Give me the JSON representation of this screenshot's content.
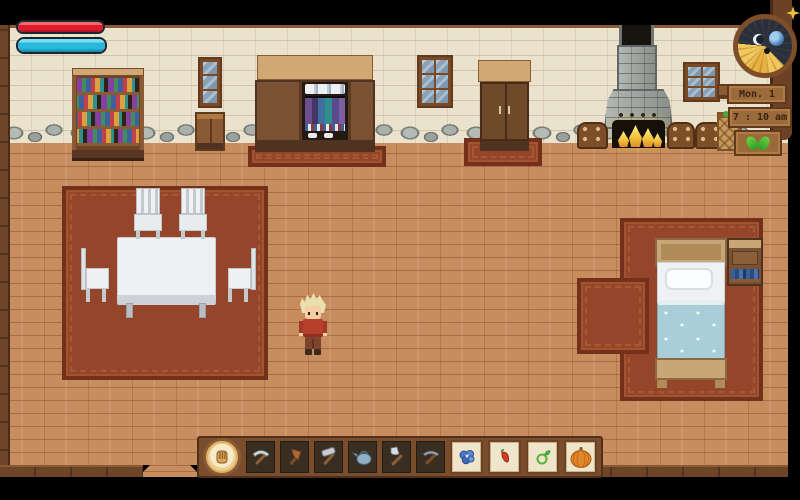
{
  "hud": {
    "health_bar": {
      "label": "health",
      "fill_percent": 100,
      "color": "#e01c2c"
    },
    "mana_bar": {
      "label": "mana",
      "fill_percent": 100,
      "color": "#29b7dc"
    }
  },
  "clock": {
    "day_label": "Mon. 1",
    "time_label": "7 : 10 am",
    "season": "spring",
    "season_icon": "sprout-icon",
    "dial_icons": [
      "sun-rays-dial",
      "moon-icon",
      "small-moon-icon",
      "star-icon"
    ]
  },
  "hotbar": {
    "selected_index": 0,
    "slots": [
      {
        "icon": "glove-icon",
        "item": "empty hand"
      },
      {
        "icon": "pickaxe-icon",
        "item": "pickaxe"
      },
      {
        "icon": "axe-icon",
        "item": "axe"
      },
      {
        "icon": "hammer-icon",
        "item": "hammer"
      },
      {
        "icon": "watering-can-icon",
        "item": "watering can"
      },
      {
        "icon": "shovel-icon",
        "item": "shovel"
      },
      {
        "icon": "dark-pickaxe-icon",
        "item": "pickaxe"
      },
      {
        "icon": "blue-flower-seeds-icon",
        "item": "blue flower seeds"
      },
      {
        "icon": "pepper-seeds-icon",
        "item": "pepper seeds"
      },
      {
        "icon": "green-onion-seeds-icon",
        "item": "onion seeds"
      },
      {
        "icon": "pumpkin-icon",
        "item": "pumpkin"
      }
    ]
  },
  "scene": {
    "objects": [
      "bookshelf",
      "window",
      "dresser",
      "open wardrobe with clothes",
      "window",
      "closed wardrobe",
      "stone fireplace with fire",
      "firewood stacks",
      "window",
      "wall shelf",
      "basket",
      "dining table with four chairs",
      "dining rug",
      "player character (blonde hair, red shirt)",
      "bed",
      "nightstand",
      "bed rug",
      "doorway"
    ]
  },
  "colors": {
    "floor": "#c78d5f",
    "wall": "#ebe2cd",
    "rug": "#94452a",
    "wood_dark": "#7a5233",
    "wood_light": "#cfa873",
    "health": "#e01c2c",
    "mana": "#29b7dc",
    "fire": "#f2c33d"
  }
}
